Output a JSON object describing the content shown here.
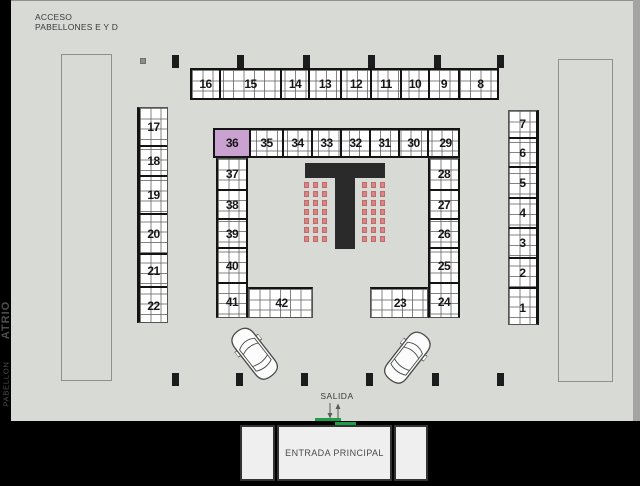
{
  "title_block": {
    "access_line1": "ACCESO",
    "access_line2": "PABELLONES E Y D"
  },
  "exit_label": "SALIDA",
  "entrance_label": "ENTRADA PRINCIPAL",
  "side_labels": {
    "pavilion": "PABELLON",
    "atrium": "ATRIO"
  },
  "booths": {
    "top_row": [
      "16",
      "15",
      "14",
      "13",
      "12",
      "11",
      "10",
      "9",
      "8"
    ],
    "middle_row": [
      "36",
      "35",
      "34",
      "33",
      "32",
      "31",
      "30",
      "29"
    ],
    "left_outer_column": [
      "17",
      "18",
      "19",
      "20",
      "21",
      "22"
    ],
    "right_outer_column": [
      "7",
      "6",
      "5",
      "4",
      "3",
      "2",
      "1"
    ],
    "left_inner_column": [
      "37",
      "38",
      "39",
      "40",
      "41"
    ],
    "right_inner_column": [
      "28",
      "27",
      "26",
      "25",
      "24"
    ],
    "bottom_left_booth": "42",
    "bottom_right_booth": "23",
    "highlighted_booth": "36"
  },
  "colors": {
    "plan_background": "#d8dad6",
    "frame_black": "#000000",
    "thick_line": "#141414",
    "highlight_purple": "#c9a2d0",
    "chair_pink": "#d98585",
    "entrance_green": "#1e9e46"
  },
  "icons": {
    "car_icon": "top-view parked car",
    "down_arrow_icon": "↓",
    "up_arrow_icon": "↑",
    "pillar_icon": "structural column",
    "chair_icon": "seat block"
  }
}
